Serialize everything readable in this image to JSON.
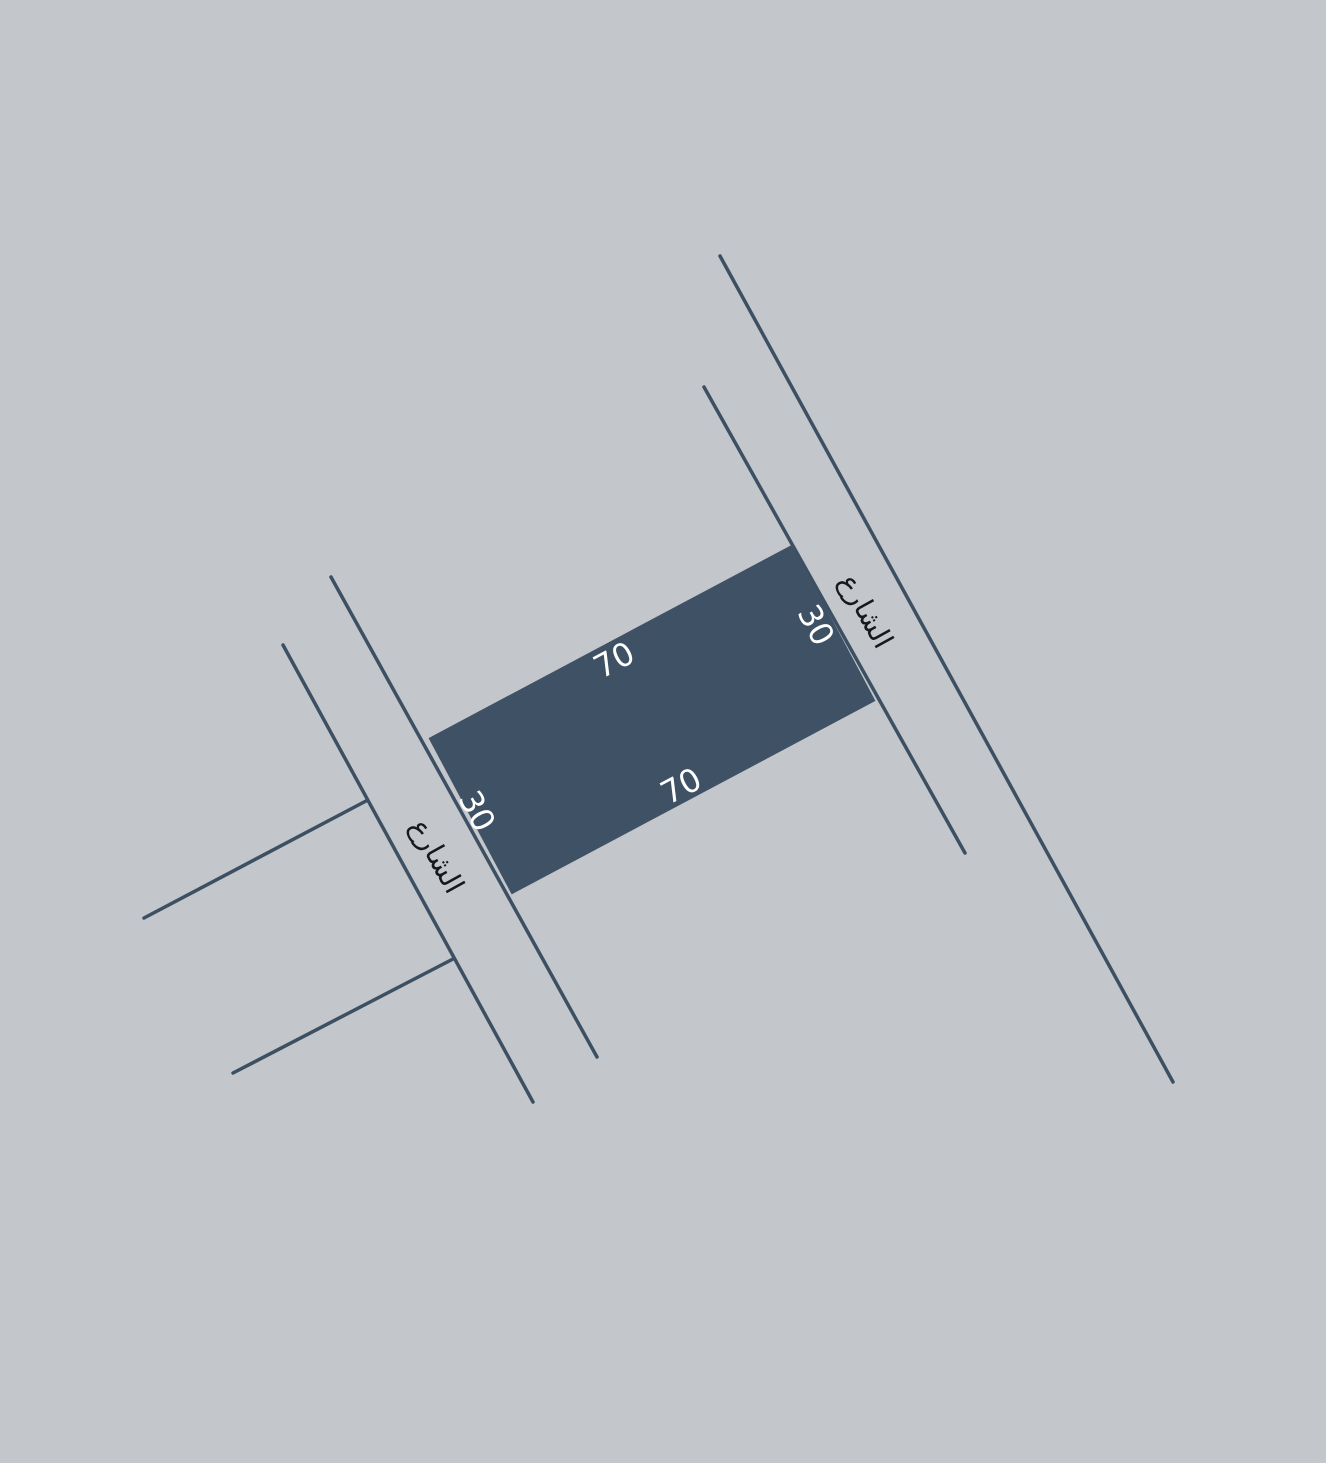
{
  "canvas": {
    "width": 1326,
    "height": 1463,
    "background": "#c3c6ca"
  },
  "colors": {
    "street_line": "#3c4f63",
    "parcel_fill": "#3f5164",
    "street_text": "#15191e",
    "dimension_text": "#ffffff"
  },
  "line_width": 3.5,
  "parcel": {
    "cx": 652,
    "cy": 719.5,
    "length": 412,
    "depth": 177,
    "angle_deg": -28
  },
  "dimension_labels": [
    {
      "text": "70",
      "x": 614,
      "y": 660,
      "angle_deg": -28,
      "edge": "top"
    },
    {
      "text": "70",
      "x": 681,
      "y": 786,
      "angle_deg": -28,
      "edge": "bottom"
    },
    {
      "text": "30",
      "x": 816,
      "y": 625,
      "angle_deg": 62,
      "edge": "right"
    },
    {
      "text": "30",
      "x": 477,
      "y": 811,
      "angle_deg": 62,
      "edge": "left"
    }
  ],
  "street_labels": [
    {
      "text": "الشارع",
      "x": 866,
      "y": 611,
      "angle_deg": 61,
      "side": "right"
    },
    {
      "text": "الشارع",
      "x": 437,
      "y": 856,
      "angle_deg": 61,
      "side": "left"
    }
  ],
  "street_lines": [
    {
      "name": "right-street-outer-edge",
      "x1": 720,
      "y1": 256,
      "x2": 1173,
      "y2": 1082
    },
    {
      "name": "right-street-inner-edge",
      "x1": 704,
      "y1": 387,
      "x2": 965,
      "y2": 853
    },
    {
      "name": "left-street-inner-edge",
      "x1": 331,
      "y1": 577,
      "x2": 597,
      "y2": 1057
    },
    {
      "name": "left-street-outer-edge",
      "x1": 283,
      "y1": 645,
      "x2": 533,
      "y2": 1102
    },
    {
      "name": "side-street-upper",
      "x1": 366,
      "y1": 801,
      "x2": 144,
      "y2": 918
    },
    {
      "name": "side-street-lower",
      "x1": 453,
      "y1": 959,
      "x2": 233,
      "y2": 1073
    }
  ]
}
